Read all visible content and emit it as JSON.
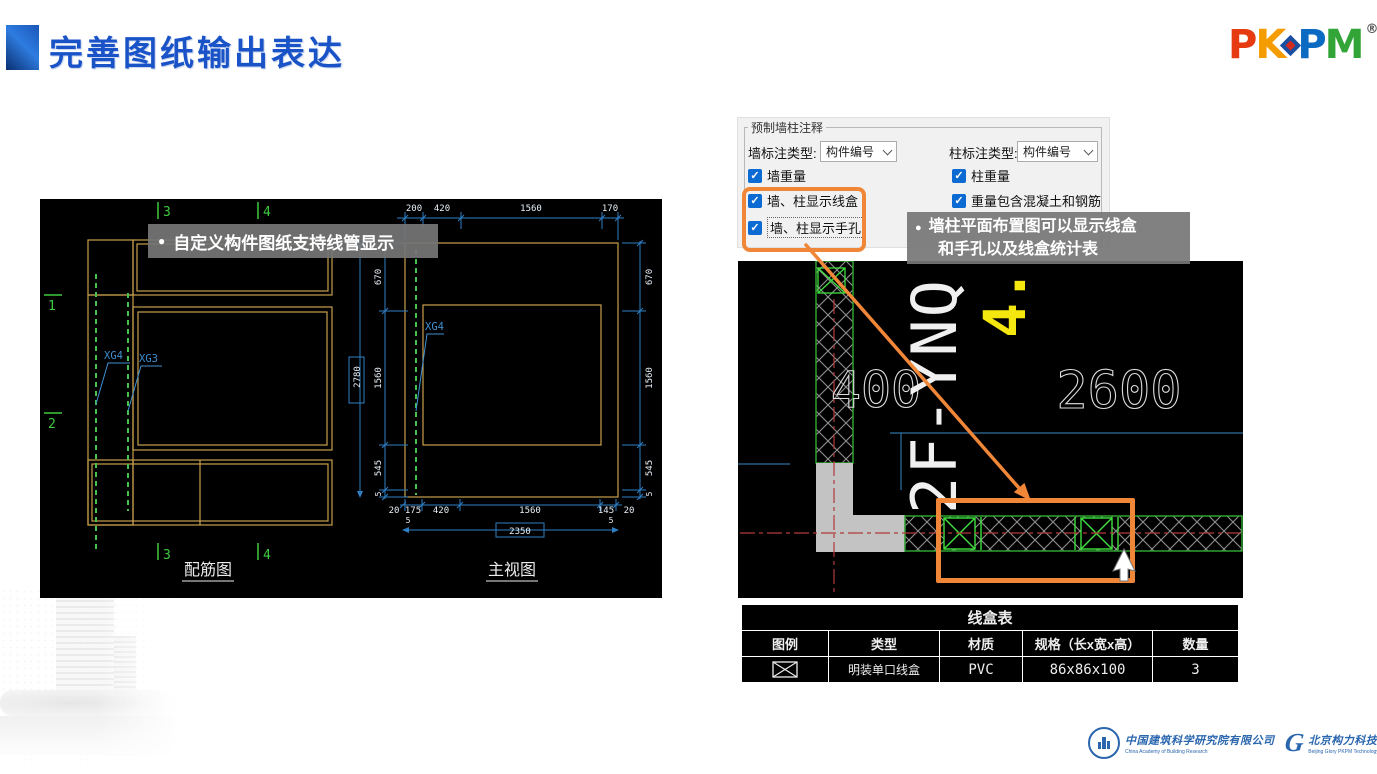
{
  "header": {
    "title": "完善图纸输出表达"
  },
  "brand": {
    "p1": "P",
    "k": "K",
    "p2": "P",
    "m": "M",
    "registered": "®"
  },
  "callout_left": {
    "bullet": "●",
    "text": "自定义构件图纸支持线管显示"
  },
  "callout_right": {
    "bullet": "●",
    "line1": "墙柱平面布置图可以显示线盒",
    "line2": "和手孔以及线盒统计表"
  },
  "dialog": {
    "group_title": "预制墙柱注释",
    "wall_type_label": "墙标注类型:",
    "wall_type_value": "构件编号",
    "column_type_label": "柱标注类型:",
    "column_type_value": "构件编号",
    "check_wall_weight": "墙重量",
    "check_column_weight": "柱重量",
    "check_show_box": "墙、柱显示线盒",
    "check_weight_concrete": "重量包含混凝土和钢筋",
    "check_show_hole": "墙、柱显示手孔",
    "checkmark": "✓"
  },
  "left_cad": {
    "axis_1": "1",
    "axis_2": "2",
    "axis_3": "3",
    "axis_4": "4",
    "xg4": "XG4",
    "xg3": "XG3",
    "dims_top": [
      "200",
      "420",
      "1560",
      "170"
    ],
    "dims_side": [
      "670",
      "1560",
      "545",
      "5"
    ],
    "total_height": "2780",
    "dims_bottom": [
      "20",
      "175",
      "420",
      "1560",
      "145",
      "20"
    ],
    "edge_offset": "5",
    "total_width": "2350",
    "title_rebar": "配筋图",
    "title_front": "主视图"
  },
  "right_cad": {
    "wall_mark": "2F-YNQ",
    "floor_mark": "4.",
    "dim_400": "400",
    "dim_2600": "2600"
  },
  "linebox_table": {
    "title": "线盒表",
    "headers": [
      "图例",
      "类型",
      "材质",
      "规格（长x宽x高）",
      "数量"
    ],
    "row": {
      "type": "明装单口线盒",
      "material": "PVC",
      "size": "86x86x100",
      "qty": "3"
    }
  },
  "footer": {
    "org1_cn": "中国建筑科学研究院有限公司",
    "org1_en": "China Academy of Building Research",
    "org2_cn": "北京构力科技有限公司",
    "org2_en": "Beijing Glory PKPM Technology Co.,Ltd."
  },
  "colors": {
    "accent_orange": "#F08637",
    "title_blue": "#1A53C7",
    "checkbox_blue": "#0B6BD3"
  }
}
